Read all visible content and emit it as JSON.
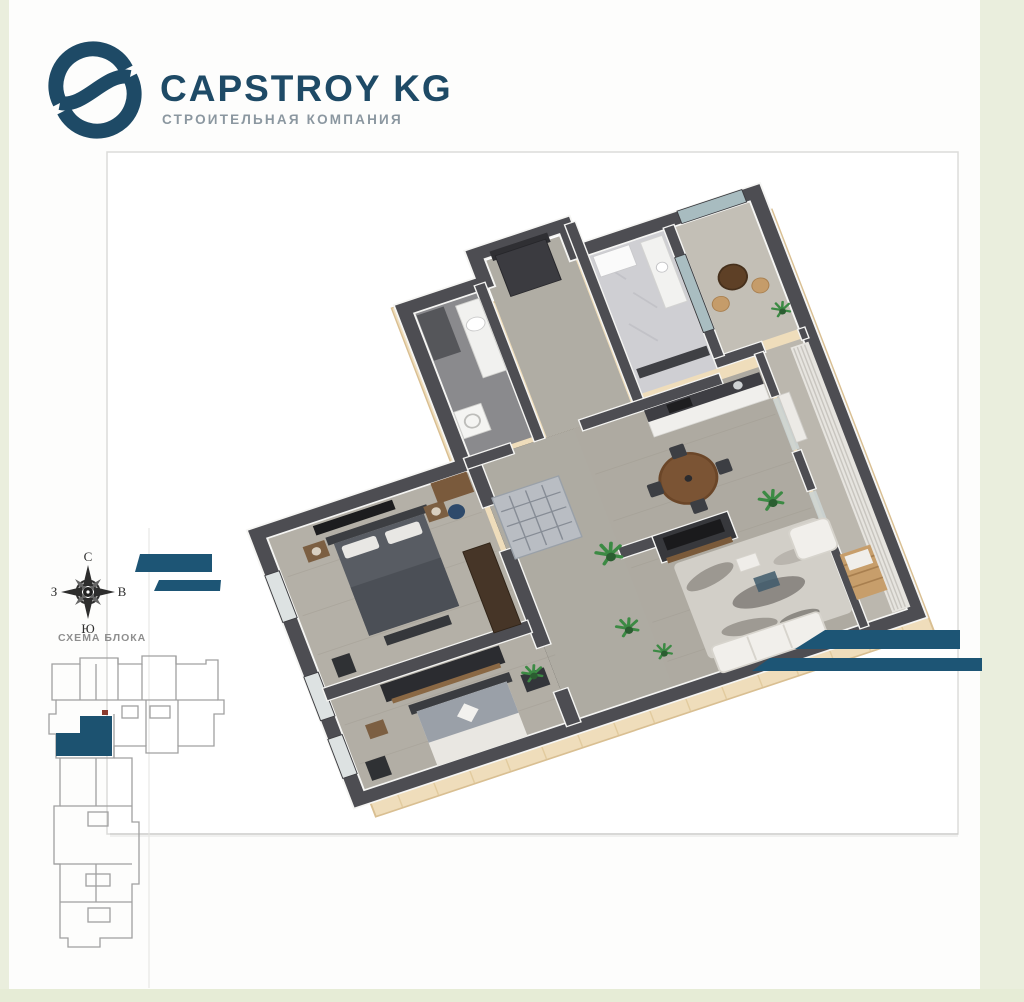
{
  "brand": {
    "name": "CAPSTROY KG",
    "tagline": "СТРОИТЕЛЬНАЯ КОМПАНИЯ"
  },
  "compass": {
    "north": "С",
    "east": "В",
    "south": "Ю",
    "west": "З"
  },
  "schematic": {
    "label": "СХЕМА БЛОКА"
  },
  "colors": {
    "logo_blue": "#1e4a66",
    "accent_teal": "#1d5575",
    "unit_highlight": "#1c5270",
    "frame_green": "#eaeedd",
    "wall_dark": "#4d4d52",
    "slab_tan": "#efddbb",
    "floor_gray": "#b0aca3"
  }
}
